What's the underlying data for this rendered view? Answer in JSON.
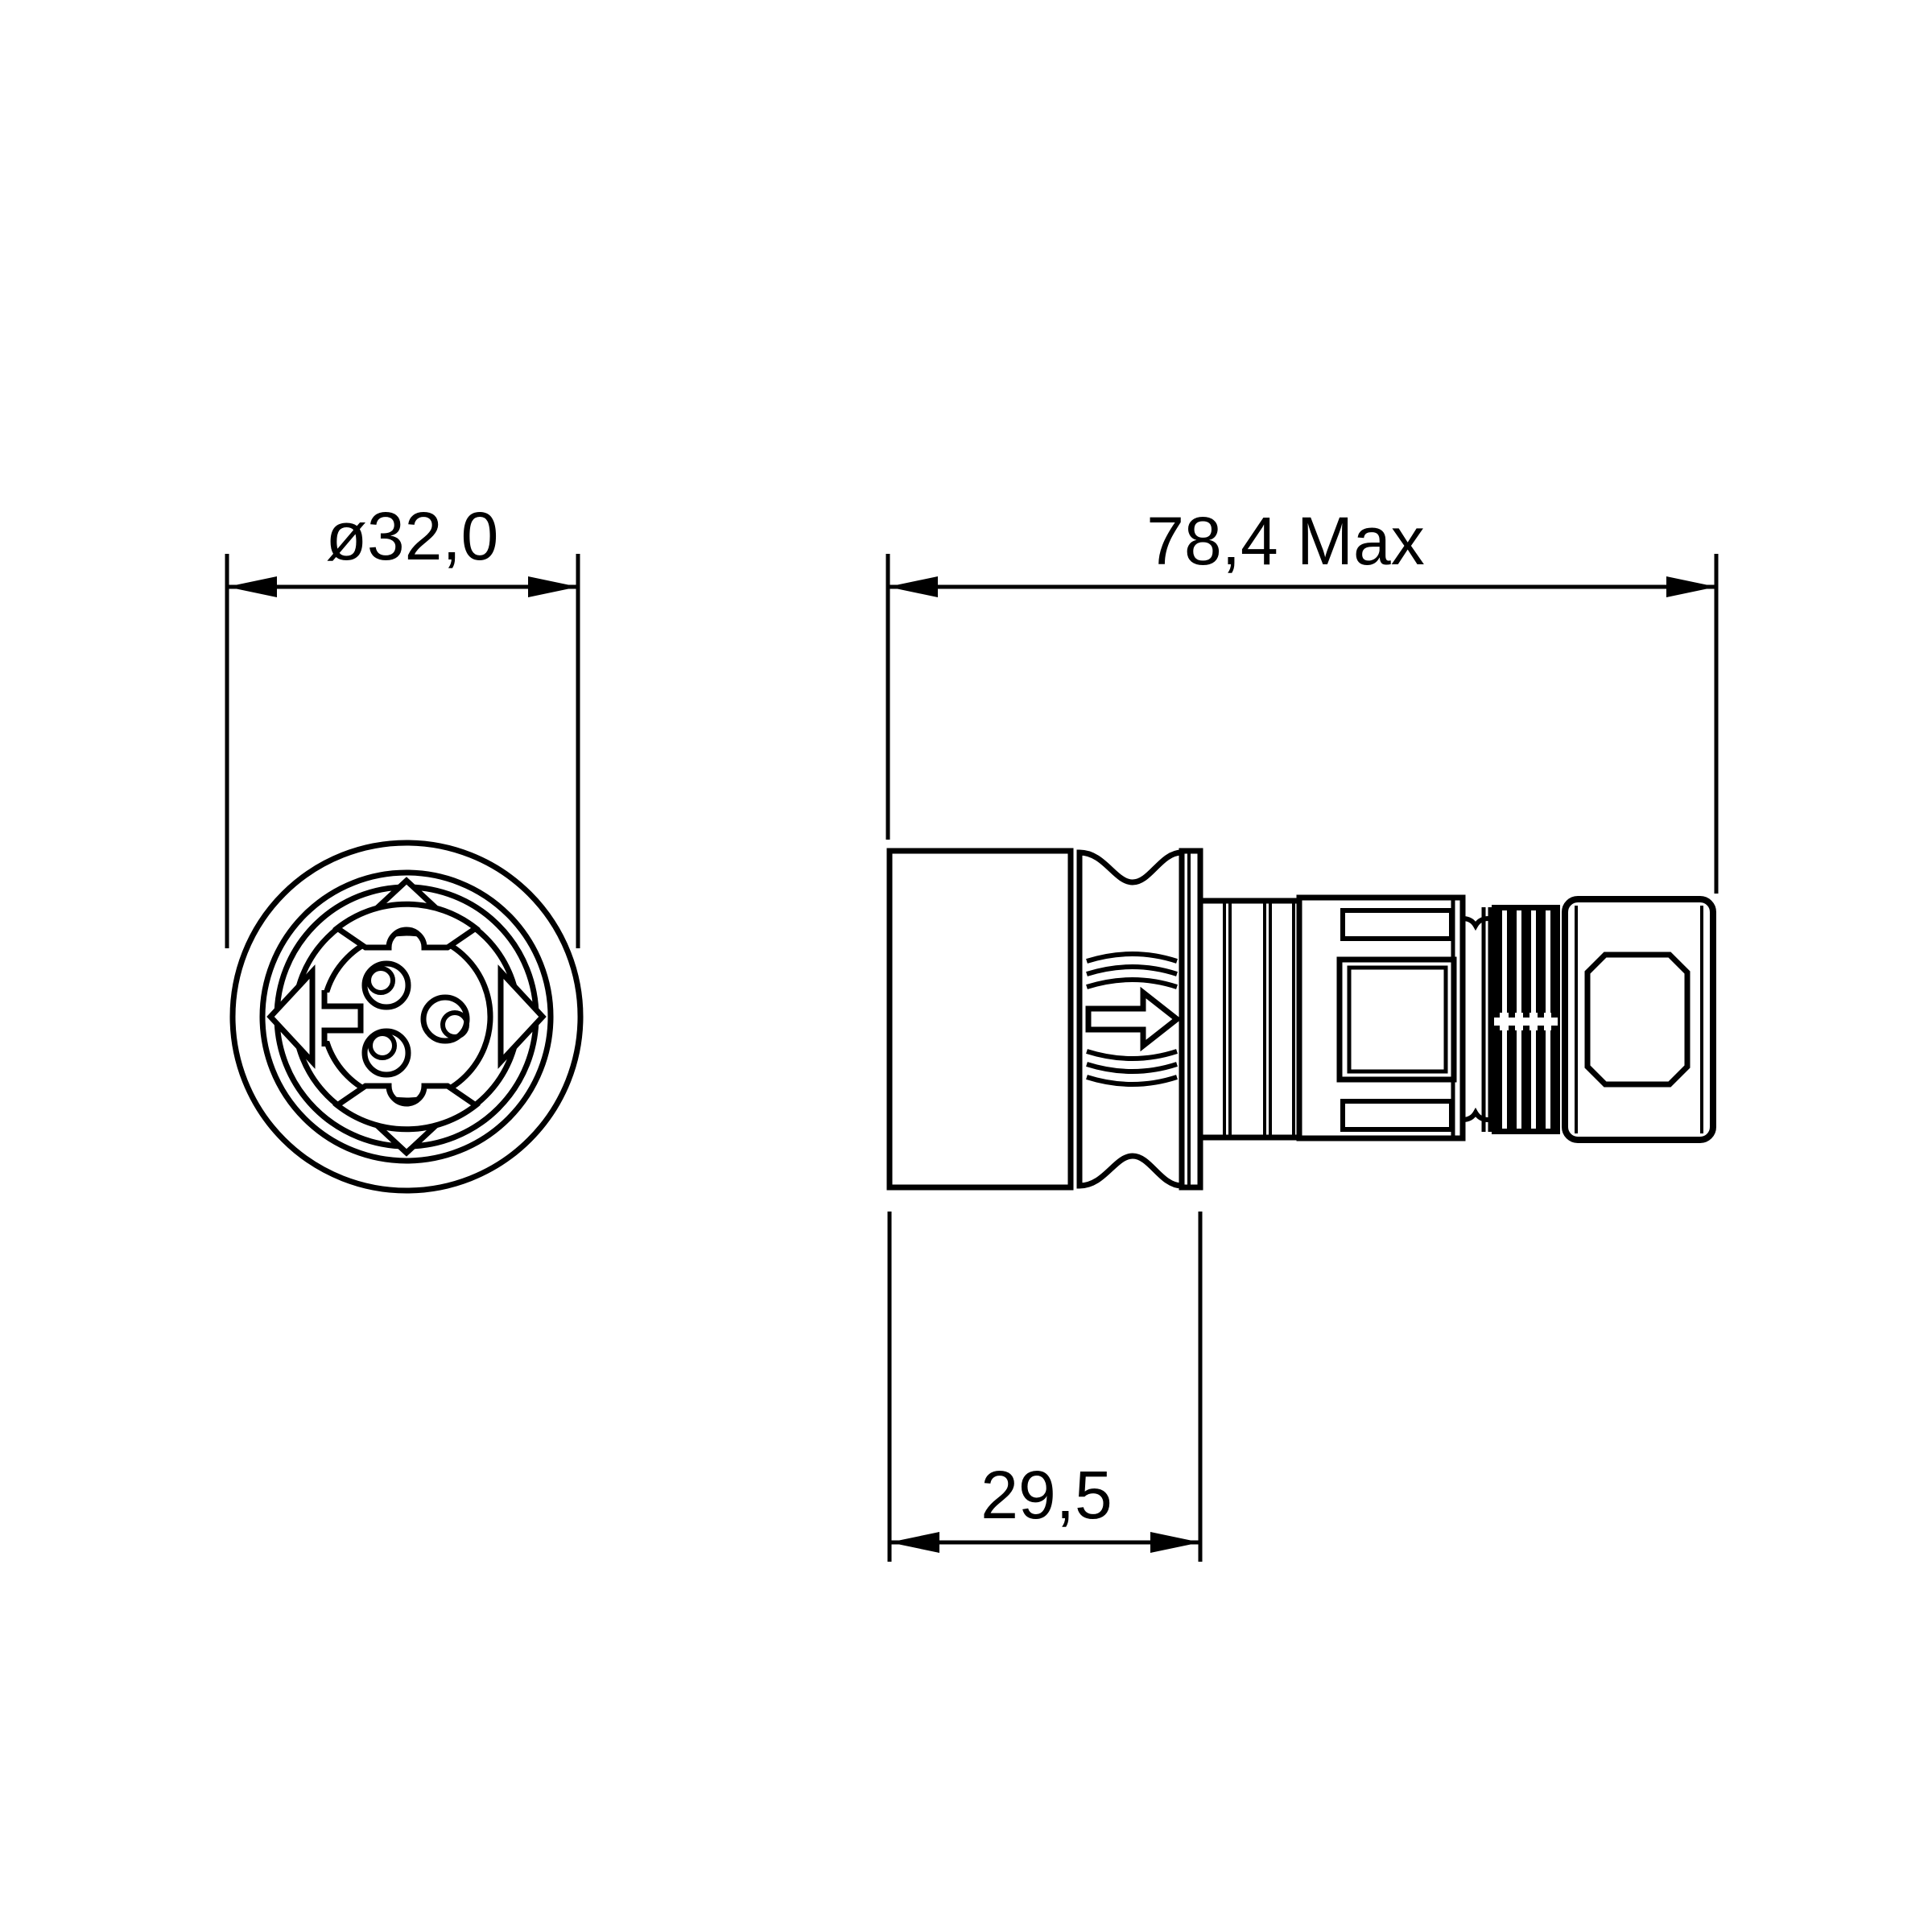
{
  "page": {
    "background": "#ffffff",
    "line_color": "#000000",
    "content": "technical drawing of circular 3-contact connector, front view and side view"
  },
  "drawing": {
    "views": [
      {
        "id": "front-view",
        "description": "connector front face, 3 contacts, keyed insert, 4 alignment triangles"
      },
      {
        "id": "side-view",
        "description": "connector side profile: rear shell, waisted grip with direction arrow, coupling barrel, latch window, ribbed strain relief, end cap"
      }
    ],
    "dimensions": {
      "front_diameter": "ø32,0",
      "overall_length": "78,4 Max",
      "rear_length": "29,5"
    },
    "contact_count": 3,
    "icons": {
      "direction_arrow": "right-arrow"
    }
  }
}
